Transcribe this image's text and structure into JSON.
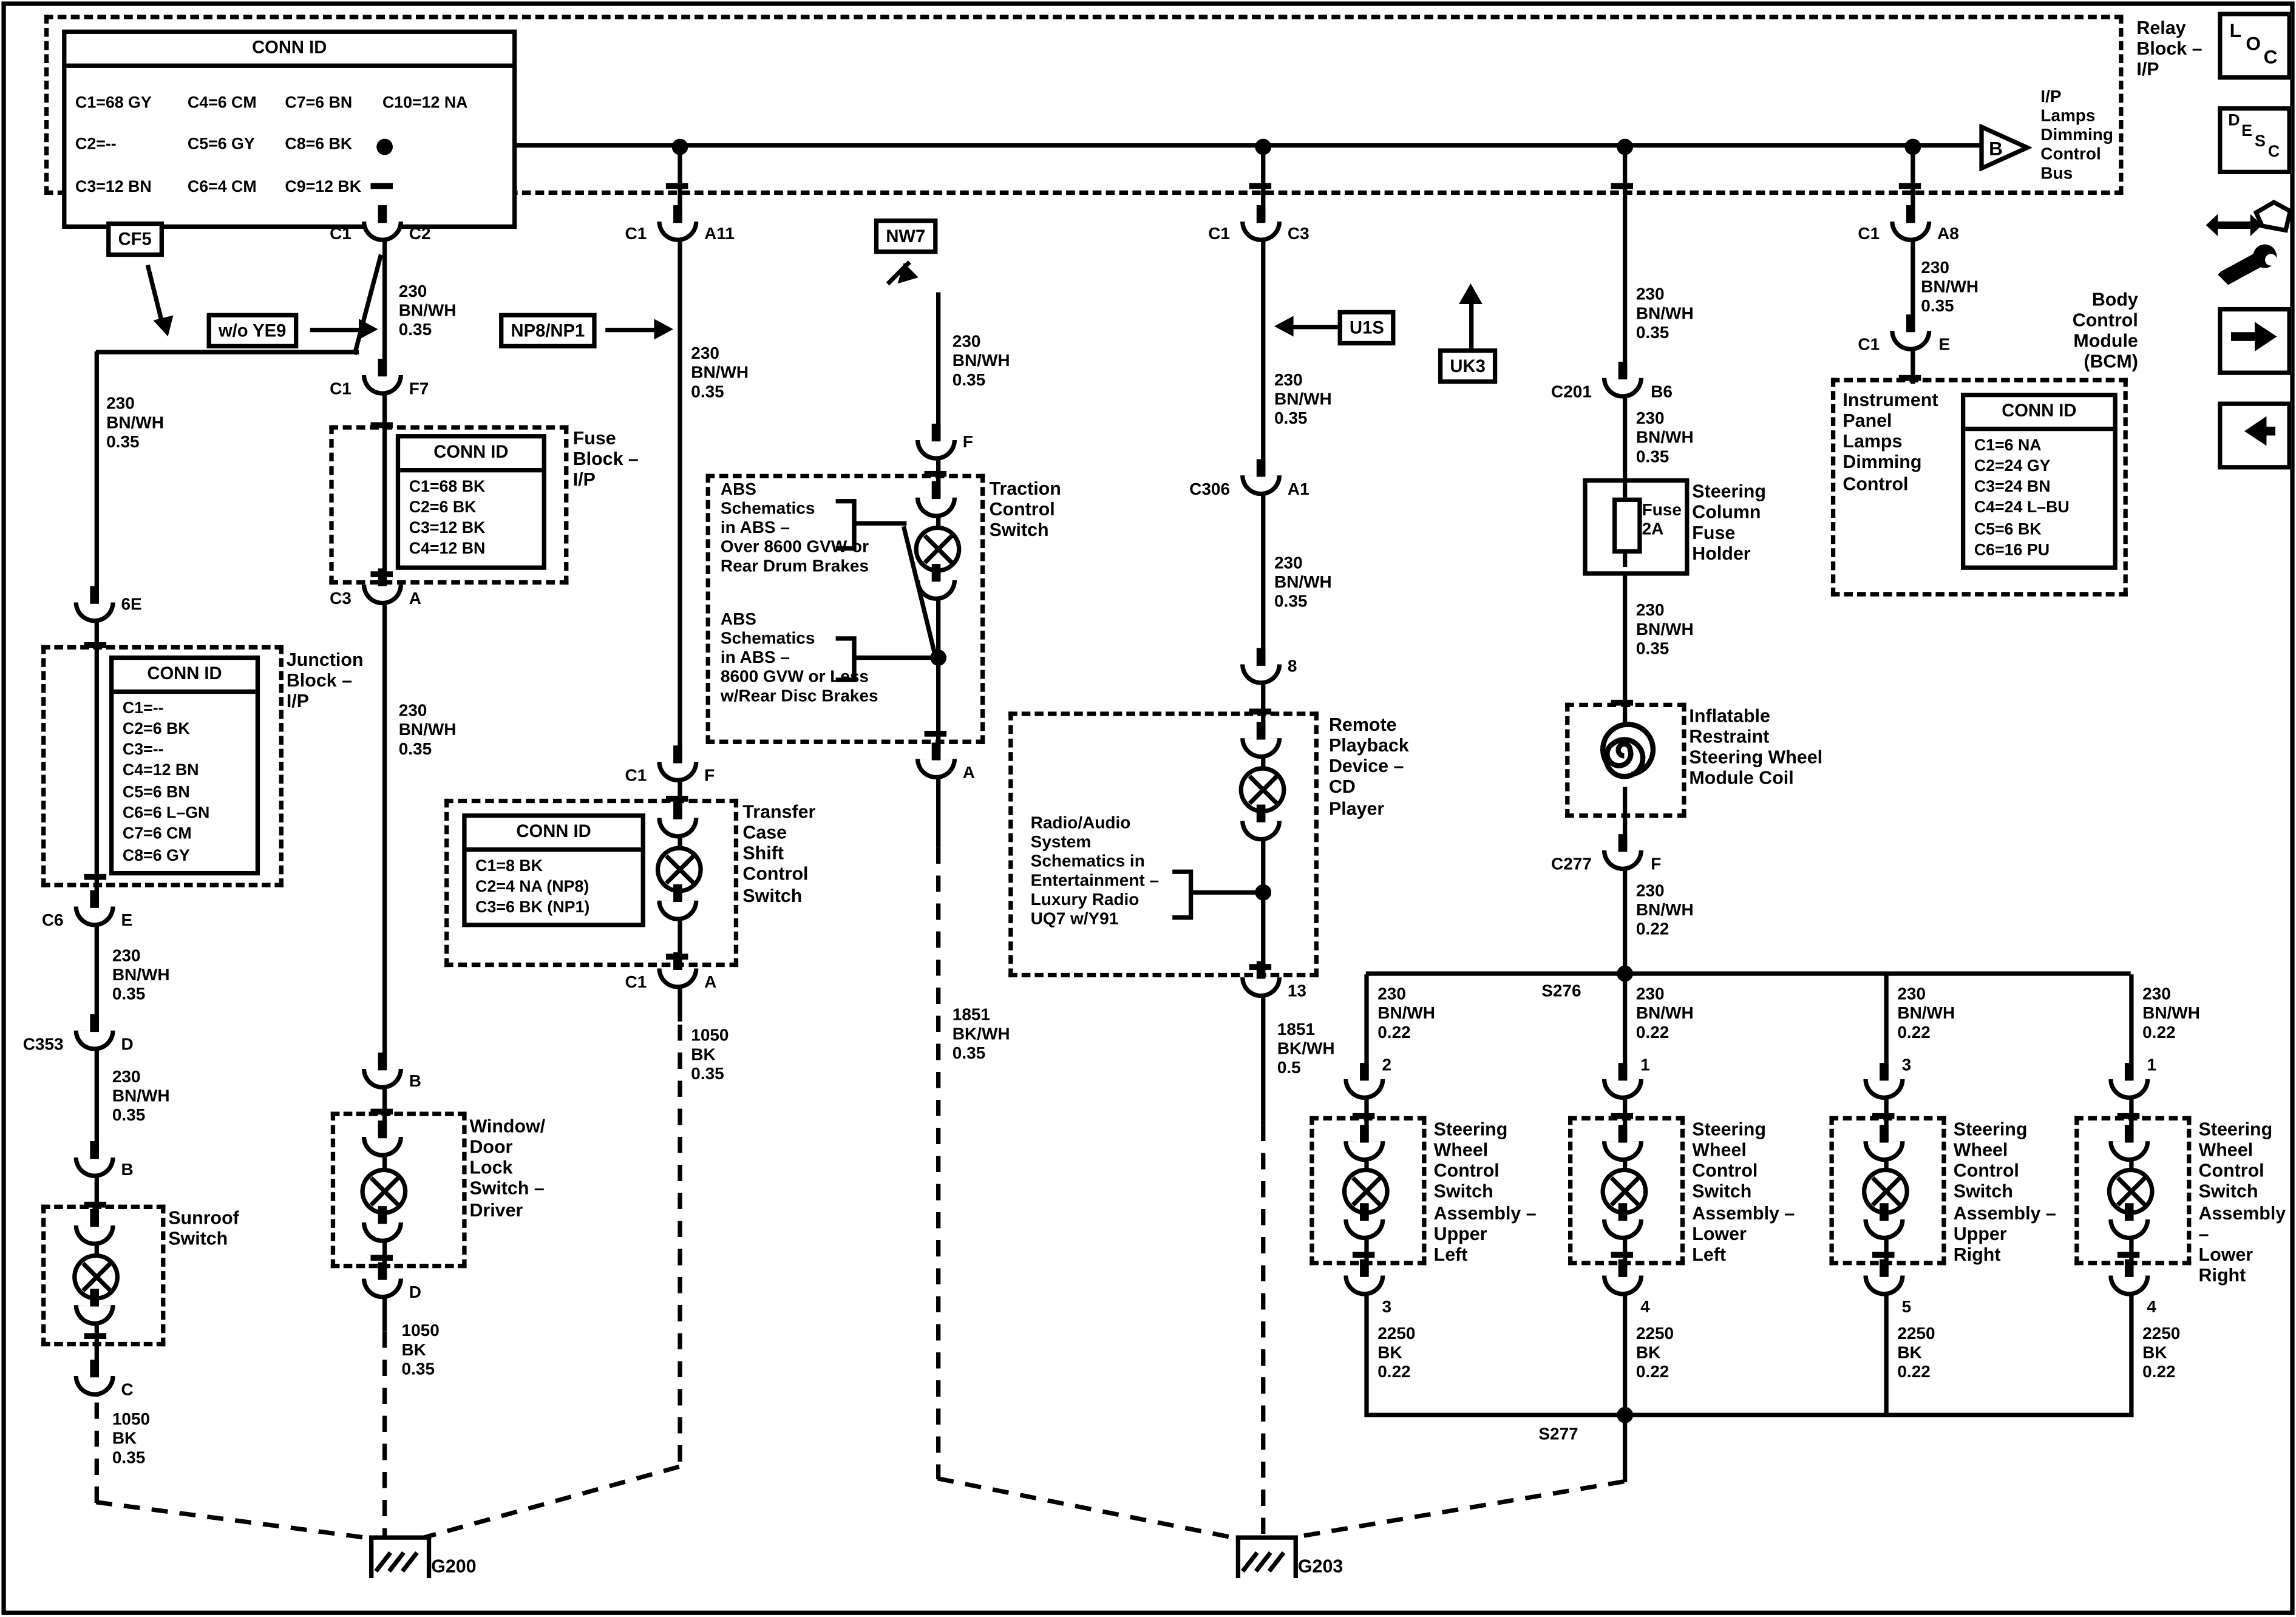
{
  "labels": {
    "relay_block": "Relay\nBlock –\nI/P",
    "bus": "I/P\nLamps\nDimming\nControl\nBus",
    "b_triangle": "B",
    "fuse_block": "Fuse\nBlock –\nI/P",
    "junction_block": "Junction\nBlock –\nI/P",
    "sunroof": "Sunroof\nSwitch",
    "window": "Window/\nDoor\nLock\nSwitch –\nDriver",
    "transfer": "Transfer\nCase\nShift\nControl\nSwitch",
    "traction": "Traction\nControl\nSwitch",
    "abs1": "ABS\nSchematics\nin ABS –\nOver 8600 GVW or\nRear Drum Brakes",
    "abs2": "ABS\nSchematics\nin ABS –\n8600 GVW or Less\nw/Rear Disc Brakes",
    "radio": "Radio/Audio\nSystem\nSchematics in\nEntertainment –\nLuxury Radio\nUQ7 w/Y91",
    "remote": "Remote\nPlayback\nDevice –\nCD\nPlayer",
    "fuse_holder": "Steering\nColumn\nFuse\nHolder",
    "fuse2a": "Fuse\n2A",
    "coil": "Inflatable\nRestraint\nSteering Wheel\nModule Coil",
    "bcm": "Body\nControl\nModule\n(BCM)",
    "bcm_inner": "Instrument\nPanel\nLamps\nDimming\nControl",
    "sw_ul": "Steering\nWheel\nControl\nSwitch\nAssembly –\nUpper\nLeft",
    "sw_ll": "Steering\nWheel\nControl\nSwitch\nAssembly –\nLower\nLeft",
    "sw_ur": "Steering\nWheel\nControl\nSwitch\nAssembly –\nUpper\nRight",
    "sw_lr": "Steering\nWheel\nControl\nSwitch\nAssembly –\nLower\nRight",
    "s276": "S276",
    "s277": "S277",
    "g200": "G200",
    "g203": "G203"
  },
  "tags": {
    "cf5": "CF5",
    "wo_ye9": "w/o YE9",
    "np8np1": "NP8/NP1",
    "nw7": "NW7",
    "u1s": "U1S",
    "uk3": "UK3"
  },
  "wires": {
    "bnwh35": "230\nBN/WH\n0.35",
    "bnwh22": "230\nBN/WH\n0.22",
    "bk35": "1050\nBK\n0.35",
    "bkwh35": "1851\nBK/WH\n0.35",
    "bkwh5": "1851\nBK/WH\n0.5",
    "bk22": "2250\nBK\n0.22"
  },
  "pins": {
    "c1": "C1",
    "c2": "C2",
    "c3": "C3",
    "a": "A",
    "b": "B",
    "c": "C",
    "d": "D",
    "e": "E",
    "f": "F",
    "f7": "F7",
    "a11": "A11",
    "a1": "A1",
    "a8": "A8",
    "b6": "B6",
    "e6": "6E",
    "c6": "C6",
    "c201": "C201",
    "c277": "C277",
    "c306": "C306",
    "c353": "C353",
    "p8": "8",
    "p13": "13",
    "p1": "1",
    "p2": "2",
    "p3": "3",
    "p4": "4",
    "p5": "5"
  },
  "tables": {
    "relay": {
      "title": "CONN ID",
      "rows": [
        [
          "C1=68 GY",
          "C4=6 CM",
          "C7=6 BN",
          "C10=12 NA"
        ],
        [
          "C2=--",
          "C5=6 GY",
          "C8=6 BK",
          ""
        ],
        [
          "C3=12 BN",
          "C6=4 CM",
          "C9=12 BK",
          ""
        ]
      ]
    },
    "fuse": {
      "title": "CONN ID",
      "body": "C1=68 BK\nC2=6 BK\nC3=12 BK\nC4=12 BN"
    },
    "junction": {
      "title": "CONN ID",
      "body": "C1=--\nC2=6 BK\nC3=--\nC4=12 BN\nC5=6 BN\nC6=6 L–GN\nC7=6 CM\nC8=6 GY"
    },
    "transfer": {
      "title": "CONN ID",
      "body": "C1=8 BK\nC2=4 NA (NP8)\nC3=6 BK (NP1)"
    },
    "bcm": {
      "title": "CONN ID",
      "body": "C1=6 NA\nC2=24 GY\nC3=24 BN\nC4=24 L–BU\nC5=6 BK\nC6=16 PU"
    }
  },
  "icons": {
    "loc": [
      "L",
      "O",
      "C"
    ],
    "desc": [
      "D",
      "E",
      "S",
      "C"
    ]
  },
  "colors": {
    "line": "#000000",
    "background": "#ffffff"
  }
}
